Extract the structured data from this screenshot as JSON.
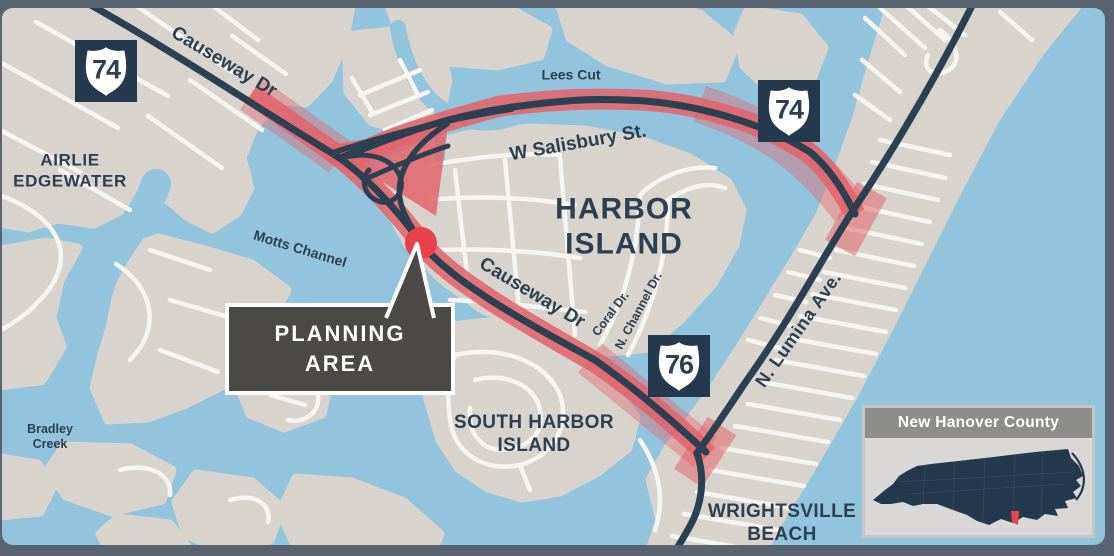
{
  "title": "Wrightsville Beach Causeway Planning Area Map",
  "colors": {
    "frame": "#5a6470",
    "water": "#92c4dd",
    "land": "#d8d4cd",
    "major_road": "#2c4051",
    "minor_road": "#f7f5f1",
    "study_corridor_red": "#e2646b",
    "marker_red": "#e8414c",
    "callout_bg": "#4a4945",
    "label_navy": "#2c4051",
    "inset_header": "#8d8d8b",
    "inset_body": "#d9d8d6",
    "state_fill": "#24394e",
    "county_red": "#e0474f"
  },
  "labels": {
    "airlie": {
      "line1": "AIRLIE",
      "line2": "EDGEWATER"
    },
    "harbor_island": {
      "line1": "HARBOR",
      "line2": "ISLAND"
    },
    "south_harbor": {
      "line1": "SOUTH HARBOR",
      "line2": "ISLAND"
    },
    "wrightsville": {
      "line1": "WRIGHTSVILLE",
      "line2": "BEACH"
    },
    "lees_cut": {
      "text": "Lees Cut"
    },
    "motts_channel": {
      "text": "Motts Channel"
    },
    "bradley_creek": {
      "line1": "Bradley",
      "line2": "Creek"
    },
    "causeway_nw": {
      "text": "Causeway Dr"
    },
    "salisbury": {
      "text": "W Salisbury St."
    },
    "causeway_se": {
      "text": "Causeway Dr"
    },
    "coral": {
      "text": "Coral Dr."
    },
    "n_channel": {
      "text": "N. Channel Dr."
    },
    "lumina": {
      "text": "N. Lumina Ave."
    }
  },
  "shields": {
    "us74_west": {
      "route": "74"
    },
    "us74_east": {
      "route": "74"
    },
    "us76": {
      "route": "76"
    }
  },
  "callout": {
    "line1": "PLANNING",
    "line2": "AREA"
  },
  "inset": {
    "title": "New Hanover County"
  }
}
